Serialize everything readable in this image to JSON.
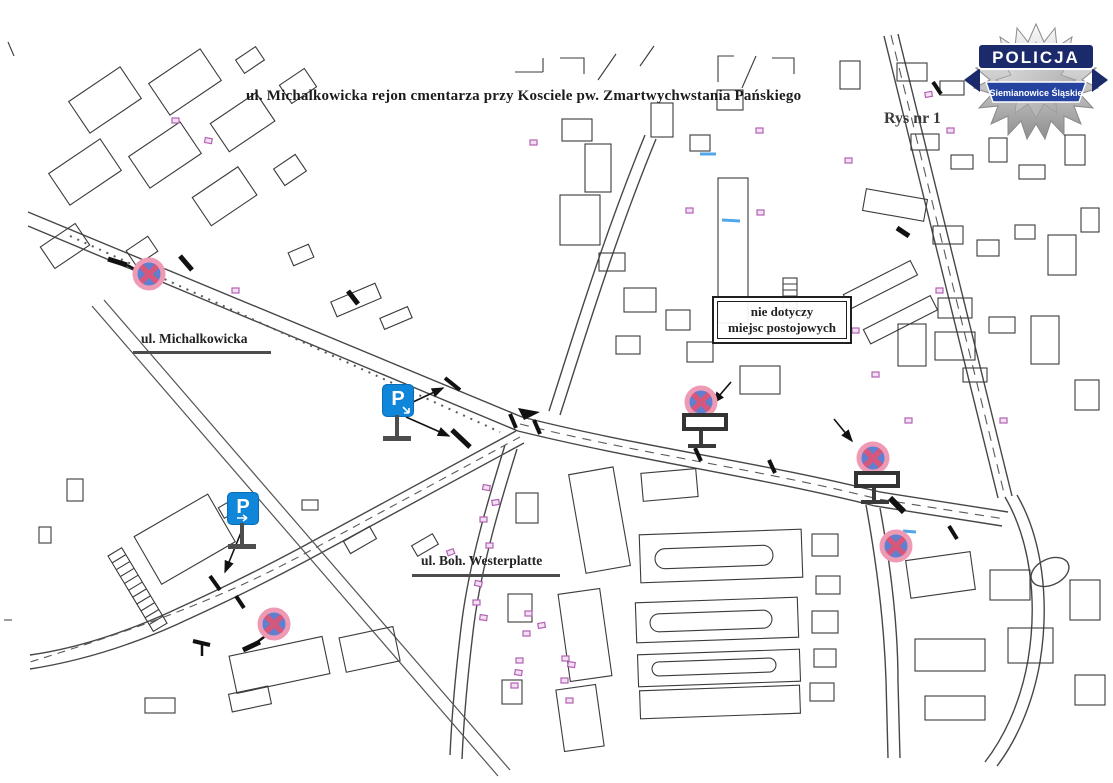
{
  "page": {
    "title": "ul. Michalkowicka rejon cmentarza przy Kosciele pw. Zmartwychwstania Pańskiego",
    "figure_label": "Rys nr 1"
  },
  "badge": {
    "org": "POLICJA",
    "unit": "Siemianowice Śląskie"
  },
  "streets": [
    {
      "label": "ul. Michalkowicka"
    },
    {
      "label": "ul. Boh. Westerplatte"
    }
  ],
  "note": {
    "line1": "nie dotyczy",
    "line2": "miejsc postojowych"
  },
  "signs": {
    "parking": [
      {
        "symbol": "P"
      },
      {
        "symbol": "P"
      }
    ],
    "no_stopping_count": 5
  },
  "colors": {
    "parking_blue": "#0f86d9",
    "no_stopping_ring": "#ef9ab5",
    "no_stopping_cross": "#d6577c",
    "no_stopping_field": "#5f7fd0",
    "map_line": "#3b3b3b",
    "pink_mark": "#b261b2",
    "badge_navy": "#1b2a6b"
  }
}
